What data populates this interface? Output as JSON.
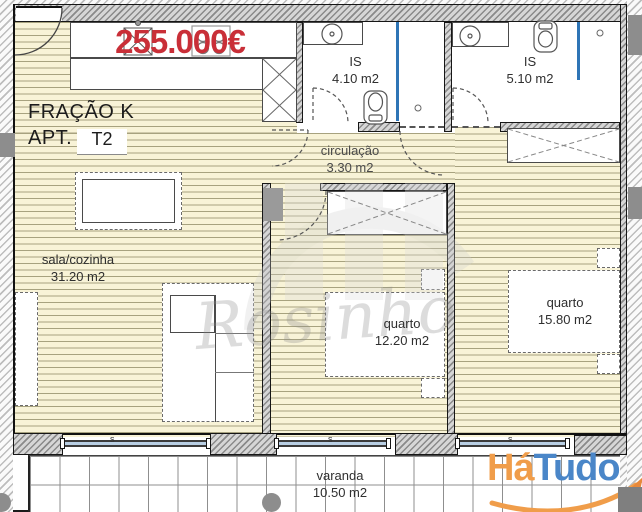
{
  "listing": {
    "price": "255.000€",
    "fraction": "FRAÇÃO K",
    "apt_label": "APT.",
    "apt_type": "T2"
  },
  "rooms": {
    "sala": {
      "name": "sala/cozinha",
      "area": "31.20 m2"
    },
    "is1": {
      "name": "IS",
      "area": "4.10 m2"
    },
    "is2": {
      "name": "IS",
      "area": "5.10 m2"
    },
    "circulacao": {
      "name": "circulação",
      "area": "3.30 m2"
    },
    "quarto1": {
      "name": "quarto",
      "area": "12.20 m2"
    },
    "quarto2": {
      "name": "quarto",
      "area": "15.80 m2"
    },
    "varanda": {
      "name": "varanda",
      "area": "10.50 m2"
    }
  },
  "windows": {
    "tag": "s"
  },
  "watermark": {
    "script": "Rosinho"
  },
  "logo": {
    "part1": "Há",
    "part2": "Tudo"
  },
  "colors": {
    "price_red": "#c92f38",
    "logo_orange": "#f09d4a",
    "logo_blue": "#4a86c8",
    "shower_blue": "#2e75b6",
    "floor_cream": "#f8f3d7"
  }
}
